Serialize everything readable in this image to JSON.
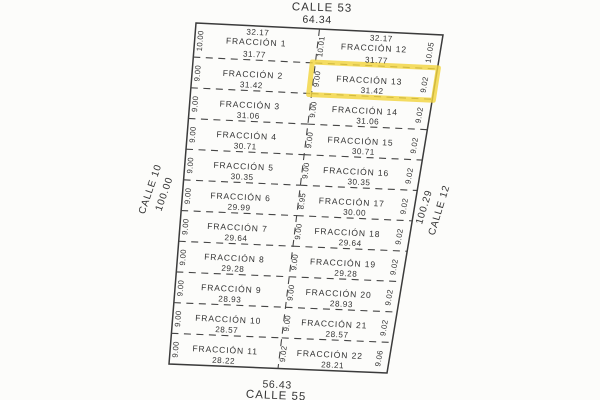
{
  "streets": {
    "top": {
      "name": "CALLE 53",
      "length": "64.34"
    },
    "bottom": {
      "name": "CALLE 55",
      "length": "56.43"
    },
    "left": {
      "name": "CALLE 10",
      "length": "100.00"
    },
    "right": {
      "name": "CALLE 12",
      "length": "100.29"
    }
  },
  "plan": {
    "highlight_color": "#f2d43f",
    "line_color": "#454545",
    "middle_values": [
      "10.01",
      "9.00",
      "9.00",
      "9.00",
      "9.00",
      "8.95",
      "9.00",
      "9.00",
      "9.00",
      "9.00",
      "9.02"
    ],
    "left_rows": [
      {
        "label": "FRACCIÓN 1",
        "top_width": "32.17",
        "width": "31.77",
        "side": "10.00"
      },
      {
        "label": "FRACCIÓN 2",
        "width": "31.42",
        "side": "9.00"
      },
      {
        "label": "FRACCIÓN 3",
        "width": "31.06",
        "side": "9.00"
      },
      {
        "label": "FRACCIÓN 4",
        "width": "30.71",
        "side": "9.00"
      },
      {
        "label": "FRACCIÓN 5",
        "width": "30.35",
        "side": "9.00"
      },
      {
        "label": "FRACCIÓN 6",
        "width": "29.99",
        "side": "9.00"
      },
      {
        "label": "FRACCIÓN 7",
        "width": "29.64",
        "side": "9.00"
      },
      {
        "label": "FRACCIÓN 8",
        "width": "29.28",
        "side": "9.00"
      },
      {
        "label": "FRACCIÓN 9",
        "width": "28.93",
        "side": "9.00"
      },
      {
        "label": "FRACCIÓN 10",
        "width": "28.57",
        "side": "9.00"
      },
      {
        "label": "FRACCIÓN 11",
        "width": "28.22",
        "side": "9.00"
      }
    ],
    "right_rows": [
      {
        "label": "FRACCIÓN 12",
        "top_width": "32.17",
        "width": "31.77",
        "side": "10.05"
      },
      {
        "label": "FRACCIÓN 13",
        "width": "31.42",
        "side": "9.02",
        "highlighted": true
      },
      {
        "label": "FRACCIÓN 14",
        "width": "31.06",
        "side": "9.02"
      },
      {
        "label": "FRACCIÓN 15",
        "width": "30.71",
        "side": "9.02"
      },
      {
        "label": "FRACCIÓN 16",
        "width": "30.35",
        "side": "9.02"
      },
      {
        "label": "FRACCIÓN 17",
        "width": "30.00",
        "side": "9.02"
      },
      {
        "label": "FRACCIÓN 18",
        "width": "29.64",
        "side": "9.02"
      },
      {
        "label": "FRACCIÓN 19",
        "width": "29.28",
        "side": "9.02"
      },
      {
        "label": "FRACCIÓN 20",
        "width": "28.93",
        "side": "9.02"
      },
      {
        "label": "FRACCIÓN 21",
        "width": "28.57",
        "side": "9.02"
      },
      {
        "label": "FRACCIÓN 22",
        "width": "28.21",
        "side": "9.06"
      }
    ]
  }
}
